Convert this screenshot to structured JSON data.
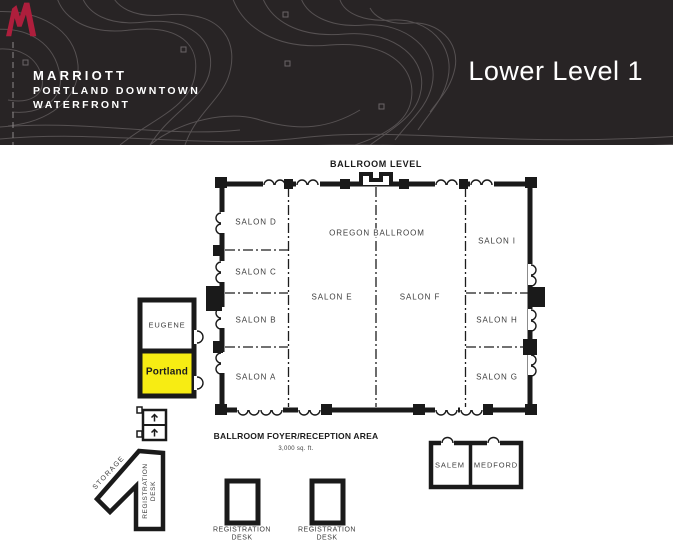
{
  "header": {
    "brand_name": "MARRIOTT",
    "brand_line2": "PORTLAND DOWNTOWN",
    "brand_line3": "WATERFRONT",
    "page_title": "Lower Level 1"
  },
  "floorplan": {
    "level_title": "BALLROOM LEVEL",
    "rooms": {
      "salon_d": "SALON D",
      "salon_c": "SALON C",
      "salon_b": "SALON B",
      "salon_a": "SALON A",
      "oregon_ballroom": "OREGON BALLROOM",
      "salon_e": "SALON E",
      "salon_f": "SALON F",
      "salon_i": "SALON I",
      "salon_h": "SALON H",
      "salon_g": "SALON G",
      "eugene": "EUGENE",
      "portland": "Portland",
      "salem": "SALEM",
      "medford": "MEDFORD"
    },
    "highlighted_room": "Portland",
    "foyer_title": "BALLROOM FOYER/RECEPTION AREA",
    "foyer_area": "3,000 sq. ft.",
    "storage_label": "STORAGE",
    "registration_desk_rotated": "REGISTRATION DESK",
    "registration_desks": [
      "REGISTRATION DESK",
      "REGISTRATION DESK"
    ],
    "colors": {
      "highlight": "#F7EC13",
      "header_background": "#282425",
      "logo_red": "#AE1E3C",
      "wall": "#1a1a1a"
    }
  }
}
